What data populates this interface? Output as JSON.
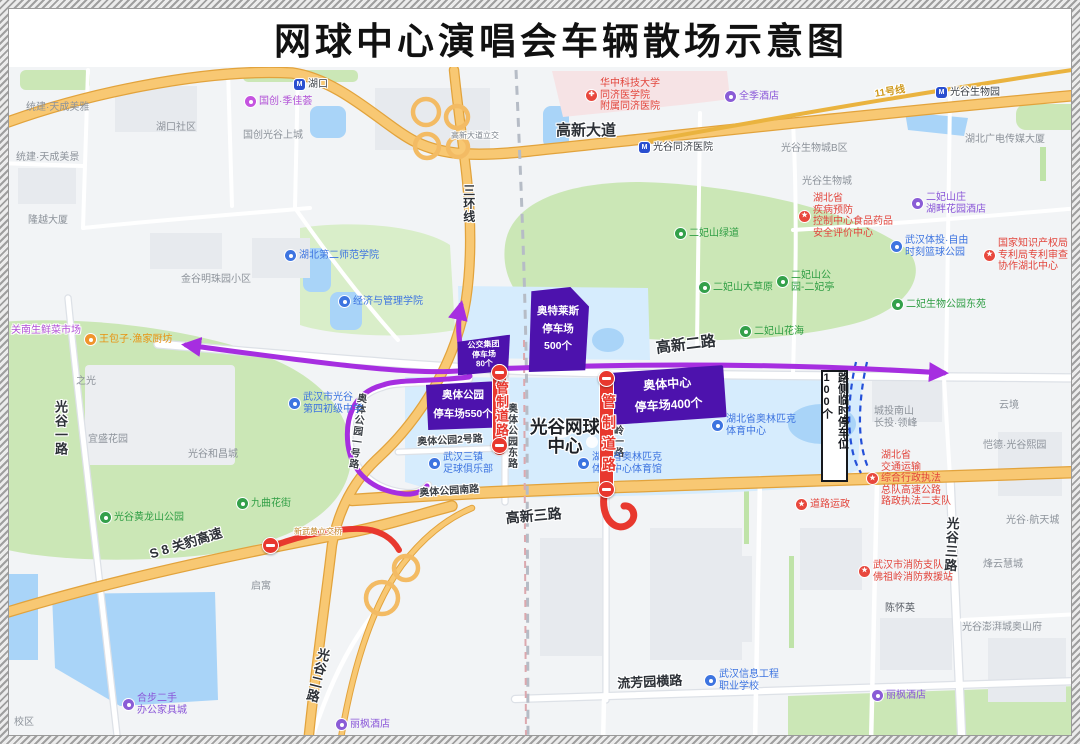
{
  "title": "网球中心演唱会车辆散场示意图",
  "colors": {
    "route_purple": "#a62ee0",
    "control_red": "#e8382e",
    "parking_purple": "#4d12ad",
    "roadside_dash_blue": "#2450d8",
    "highway_orange": "#f8c873",
    "water_blue": "#a9d4f8",
    "park_green": "#cbe7b6"
  },
  "parking": {
    "zones": [
      {
        "name": "outlets-parking",
        "lines": [
          "奥特莱斯",
          "停车场",
          "500个"
        ]
      },
      {
        "name": "bus-group-parking",
        "lines": [
          "公交集团",
          "停车场",
          "80个"
        ]
      },
      {
        "name": "aoti-park-parking",
        "lines": [
          "奥体公园",
          "停车场550个"
        ]
      },
      {
        "name": "aoti-center-parking",
        "lines": [
          "奥体中心",
          "停车场400个"
        ]
      }
    ]
  },
  "control_label": "管制道路",
  "roadside_label": "路侧临时停车位100个",
  "map": {
    "center_label": [
      "光谷网球",
      "中心"
    ],
    "labels": [
      {
        "n": "road-gaoxin-avenue",
        "t": "road",
        "txt": "高新大道",
        "x": 556,
        "y": 122,
        "s": 15
      },
      {
        "n": "road-gaoxin-2",
        "t": "road",
        "txt": "高新二路",
        "x": 655,
        "y": 340,
        "s": 15,
        "r": -7
      },
      {
        "n": "road-gaoxin-3",
        "t": "road",
        "txt": "高新三路",
        "x": 505,
        "y": 510,
        "s": 14,
        "r": -5
      },
      {
        "n": "road-liufangyuan-heng",
        "t": "road",
        "txt": "流芳园横路",
        "x": 617,
        "y": 677,
        "s": 13,
        "r": -3
      },
      {
        "n": "road-sanhuan-line",
        "t": "road",
        "txt": "三环线",
        "x": 461,
        "y": 184,
        "s": 12,
        "v": 1
      },
      {
        "n": "road-guanggu-1",
        "t": "road",
        "txt": "光谷一路",
        "x": 52,
        "y": 400,
        "s": 13,
        "v": 1
      },
      {
        "n": "road-guanggu-2",
        "t": "road",
        "txt": "光谷二路",
        "x": 316,
        "y": 646,
        "s": 13,
        "v": 1,
        "r": 14
      },
      {
        "n": "road-guanggu-3",
        "t": "road",
        "txt": "光谷三路",
        "x": 944,
        "y": 516,
        "s": 13,
        "v": 1,
        "r": 3
      },
      {
        "n": "road-s8-guanbao-expwy",
        "t": "road",
        "txt": "S 8 关豹高速",
        "x": 148,
        "y": 548,
        "s": 13,
        "r": -17
      },
      {
        "n": "road-aoti-south",
        "t": "onroad",
        "txt": "奥体公园南路",
        "x": 419,
        "y": 488,
        "s": 10,
        "r": -4
      },
      {
        "n": "road-aoti-east",
        "t": "onroad",
        "txt": "奥体公园东路",
        "x": 505,
        "y": 403,
        "s": 10,
        "v": 1
      },
      {
        "n": "road-fozuling-1",
        "t": "onroad",
        "txt": "佛祖岭一路",
        "x": 611,
        "y": 403,
        "s": 10,
        "v": 1
      },
      {
        "n": "road-aoti-1",
        "t": "onroad",
        "txt": "奥体公园一号路",
        "x": 355,
        "y": 392,
        "s": 10,
        "v": 1,
        "r": 7
      },
      {
        "n": "road-aoti-2",
        "t": "onroad",
        "txt": "奥体公园2号路",
        "x": 417,
        "y": 437,
        "s": 10,
        "r": -3
      },
      {
        "n": "label-gaoxin-interchange",
        "t": "plain",
        "txt": "高新大道立交",
        "x": 451,
        "y": 131,
        "s": 8,
        "col": "#7c838c"
      },
      {
        "n": "label-xinwuhuang-interchange",
        "t": "plain",
        "txt": "新武黄立交桥",
        "x": 294,
        "y": 527,
        "s": 8,
        "col": "#c3872b"
      },
      {
        "n": "label-metro-line-11",
        "t": "onroad",
        "txt": "11号线",
        "x": 874,
        "y": 89,
        "s": 10,
        "r": -9,
        "col": "#cf9a1e"
      },
      {
        "n": "area-tianchengmeiya",
        "t": "area",
        "txt": "统建·天成美雅",
        "x": 26,
        "y": 102,
        "s": 10
      },
      {
        "n": "area-hukou-community",
        "t": "area",
        "txt": "湖口社区",
        "x": 156,
        "y": 122,
        "s": 10
      },
      {
        "n": "area-guochuang-shangcheng",
        "t": "area",
        "txt": "国创光谷上城",
        "x": 243,
        "y": 130,
        "s": 10
      },
      {
        "n": "area-tianchengmeijing",
        "t": "area",
        "txt": "统建·天成美景",
        "x": 16,
        "y": 152,
        "s": 10
      },
      {
        "n": "area-longyue-tower",
        "t": "area",
        "txt": "隆越大厦",
        "x": 28,
        "y": 215,
        "s": 10
      },
      {
        "n": "area-jingu-mingzhu",
        "t": "area",
        "txt": "金谷明珠园小区",
        "x": 181,
        "y": 274,
        "s": 10
      },
      {
        "n": "area-biocity-b",
        "t": "area",
        "txt": "光谷生物城B区",
        "x": 781,
        "y": 143,
        "s": 10
      },
      {
        "n": "area-biocity",
        "t": "area",
        "txt": "光谷生物城",
        "x": 802,
        "y": 176,
        "s": 10
      },
      {
        "n": "area-gdtv-tower",
        "t": "area",
        "txt": "湖北广电传媒大厦",
        "x": 965,
        "y": 134,
        "s": 10
      },
      {
        "n": "area-zhiguang",
        "t": "area",
        "txt": "之光",
        "x": 76,
        "y": 376,
        "s": 10
      },
      {
        "n": "area-yisheng-garden",
        "t": "area",
        "txt": "宜盛花园",
        "x": 88,
        "y": 434,
        "s": 10
      },
      {
        "n": "area-hechangcheng",
        "t": "area",
        "txt": "光谷和昌城",
        "x": 188,
        "y": 449,
        "s": 10
      },
      {
        "n": "area-qiyu",
        "t": "area",
        "txt": "启寓",
        "x": 251,
        "y": 581,
        "s": 10
      },
      {
        "n": "area-yunjing",
        "t": "area",
        "txt": "云境",
        "x": 999,
        "y": 400,
        "s": 10
      },
      {
        "n": "area-chengtou-nanshan",
        "t": "area",
        "lines": [
          "城投南山",
          "长投·领峰"
        ],
        "x": 874,
        "y": 406,
        "s": 10
      },
      {
        "n": "area-kaide-xiyuan",
        "t": "area",
        "txt": "恺德·光谷熙园",
        "x": 983,
        "y": 440,
        "s": 10
      },
      {
        "n": "area-hangtiancheng",
        "t": "area",
        "txt": "光谷·航天城",
        "x": 1006,
        "y": 515,
        "s": 10
      },
      {
        "n": "area-fengyunhuicheng",
        "t": "area",
        "txt": "烽云慧城",
        "x": 983,
        "y": 559,
        "s": 10
      },
      {
        "n": "area-pengpaicheng",
        "t": "area",
        "txt": "光谷澎湃城奥山府",
        "x": 962,
        "y": 622,
        "s": 10
      },
      {
        "n": "area-chenhuaiying",
        "t": "area",
        "txt": "陈怀英",
        "x": 885,
        "y": 603,
        "s": 10,
        "col": "#565b63"
      },
      {
        "n": "area-xiaoqu",
        "t": "area",
        "txt": "校区",
        "x": 14,
        "y": 717,
        "s": 10
      },
      {
        "n": "poi-tongji-hospital",
        "t": "poi c-red",
        "pin": "red",
        "g": "✚",
        "lines": [
          "华中科技大学",
          "同济医学院",
          "附属同济医院"
        ],
        "x": 586,
        "y": 78,
        "s": 10
      },
      {
        "n": "poi-cdc-center",
        "t": "poi c-red",
        "pin": "red",
        "g": "★",
        "lines": [
          "湖北省",
          "疾病预防",
          "控制中心食品药品",
          "安全评价中心"
        ],
        "x": 799,
        "y": 193,
        "s": 10
      },
      {
        "n": "poi-patent-office",
        "t": "poi c-red",
        "pin": "red",
        "g": "★",
        "lines": [
          "国家知识产权局",
          "专利局专利审查",
          "协作湖北中心"
        ],
        "x": 984,
        "y": 238,
        "s": 10
      },
      {
        "n": "poi-transport-enforcement",
        "t": "poi c-red",
        "pin": "red",
        "g": "★",
        "lines": [
          "湖北省",
          "交通运输",
          "综合行政执法",
          "总队高速公路",
          "路政执法二支队"
        ],
        "x": 867,
        "y": 450,
        "s": 10
      },
      {
        "n": "poi-fire-station",
        "t": "poi c-red",
        "pin": "red",
        "g": "★",
        "lines": [
          "武汉市消防支队",
          "佛祖岭消防救援站"
        ],
        "x": 859,
        "y": 560,
        "s": 10
      },
      {
        "n": "poi-road-transport-admin",
        "t": "poi c-red",
        "pin": "red",
        "g": "★",
        "txt": "道路运政",
        "x": 796,
        "y": 499,
        "s": 10
      },
      {
        "n": "poi-metro-hukou",
        "t": "metro",
        "pin": "metro",
        "g": "M",
        "txt": "湖口",
        "x": 294,
        "y": 79,
        "s": 10
      },
      {
        "n": "poi-metro-tongji-hospital",
        "t": "metro",
        "pin": "metro",
        "g": "M",
        "txt": "光谷同济医院",
        "x": 639,
        "y": 142,
        "s": 10
      },
      {
        "n": "poi-metro-biopark",
        "t": "metro",
        "pin": "metro",
        "g": "M",
        "txt": "光谷生物园",
        "x": 936,
        "y": 87,
        "s": 10
      },
      {
        "n": "poi-hubei-2nd-normal-univ",
        "t": "poi c-blue",
        "pin": "blue",
        "txt": "湖北第二师范学院",
        "x": 285,
        "y": 250,
        "s": 10
      },
      {
        "n": "poi-econ-mgmt-college",
        "t": "poi c-blue",
        "pin": "blue",
        "txt": "经济与管理学院",
        "x": 339,
        "y": 296,
        "s": 10
      },
      {
        "n": "poi-guanggu-4th-school",
        "t": "poi c-blue",
        "pin": "blue",
        "lines": [
          "武汉市光谷",
          "第四初级中学"
        ],
        "x": 289,
        "y": 392,
        "s": 10
      },
      {
        "n": "poi-three-towns-fc",
        "t": "poi c-blue",
        "pin": "blue",
        "lines": [
          "武汉三镇",
          "足球俱乐部"
        ],
        "x": 429,
        "y": 452,
        "s": 10
      },
      {
        "n": "poi-hubei-olympic-center",
        "t": "poi c-blue",
        "pin": "blue",
        "lines": [
          "湖北省奥林匹克",
          "体育中心"
        ],
        "x": 712,
        "y": 414,
        "s": 10
      },
      {
        "n": "poi-olympic-gymnasium",
        "t": "poi c-blue",
        "pin": "blue",
        "lines": [
          "湖北省奥林匹克",
          "体育中心体育馆"
        ],
        "x": 578,
        "y": 452,
        "s": 10
      },
      {
        "n": "poi-basketball-park",
        "t": "poi c-blue",
        "pin": "blue",
        "lines": [
          "武汉体投·自由",
          "时刻篮球公园"
        ],
        "x": 891,
        "y": 235,
        "s": 10
      },
      {
        "n": "poi-info-engineering-school",
        "t": "poi c-blue",
        "pin": "blue",
        "lines": [
          "武汉信息工程",
          "职业学校"
        ],
        "x": 705,
        "y": 669,
        "s": 10
      },
      {
        "n": "poi-erfeishan-greenway",
        "t": "poi c-green",
        "pin": "green",
        "txt": "二妃山绿道",
        "x": 675,
        "y": 228,
        "s": 10
      },
      {
        "n": "poi-erfeishan-grassland",
        "t": "poi c-green",
        "pin": "green",
        "txt": "二妃山大草原",
        "x": 699,
        "y": 282,
        "s": 10
      },
      {
        "n": "poi-erfeishan-pavilion",
        "t": "poi c-green",
        "pin": "green",
        "lines": [
          "二妃山公",
          "园-二妃亭"
        ],
        "x": 777,
        "y": 270,
        "s": 10
      },
      {
        "n": "poi-erfeishan-flower-sea",
        "t": "poi c-green",
        "pin": "green",
        "txt": "二妃山花海",
        "x": 740,
        "y": 326,
        "s": 10
      },
      {
        "n": "poi-jiuqu-flower-street",
        "t": "poi c-green",
        "pin": "green",
        "txt": "九曲花街",
        "x": 237,
        "y": 498,
        "s": 10
      },
      {
        "n": "poi-huanglongshan-park",
        "t": "poi c-green",
        "pin": "green",
        "txt": "光谷黄龙山公园",
        "x": 100,
        "y": 512,
        "s": 10
      },
      {
        "n": "poi-erfei-bio-park-east",
        "t": "poi c-green",
        "pin": "green",
        "txt": "二妃生物公园东苑",
        "x": 892,
        "y": 299,
        "s": 10
      },
      {
        "n": "poi-allseasons-hotel",
        "t": "poi c-purple",
        "pin": "purple",
        "txt": "全季酒店",
        "x": 725,
        "y": 91,
        "s": 10
      },
      {
        "n": "poi-erfeishanzhuang-hotel",
        "t": "poi c-purple",
        "pin": "purple",
        "lines": [
          "二妃山庄",
          "湖畔花园酒店"
        ],
        "x": 912,
        "y": 192,
        "s": 10
      },
      {
        "n": "poi-lavande-hotel-west",
        "t": "poi c-purple",
        "pin": "purple",
        "txt": "丽枫酒店",
        "x": 336,
        "y": 719,
        "s": 10
      },
      {
        "n": "poi-lavande-hotel-east",
        "t": "poi c-purple",
        "pin": "purple",
        "txt": "丽枫酒店",
        "x": 872,
        "y": 690,
        "s": 10
      },
      {
        "n": "poi-hebu-furniture-mall",
        "t": "poi c-purple",
        "pin": "purple",
        "lines": [
          "合步二手",
          "办公家具城"
        ],
        "x": 123,
        "y": 693,
        "s": 10
      },
      {
        "n": "poi-guochuang-jijiahui",
        "t": "poi c-magenta",
        "pin": "magenta",
        "txt": "国创·季佳荟",
        "x": 245,
        "y": 96,
        "s": 10
      },
      {
        "n": "label-guannan-market",
        "t": "plain",
        "txt": "关南生鲜菜市场",
        "x": 11,
        "y": 325,
        "s": 10,
        "col": "#b14fd6"
      },
      {
        "n": "poi-wangbaozi-restaurant",
        "t": "poi c-orange",
        "pin": "orange",
        "txt": "王包子·渔家厨坊",
        "x": 85,
        "y": 334,
        "s": 10
      }
    ]
  }
}
